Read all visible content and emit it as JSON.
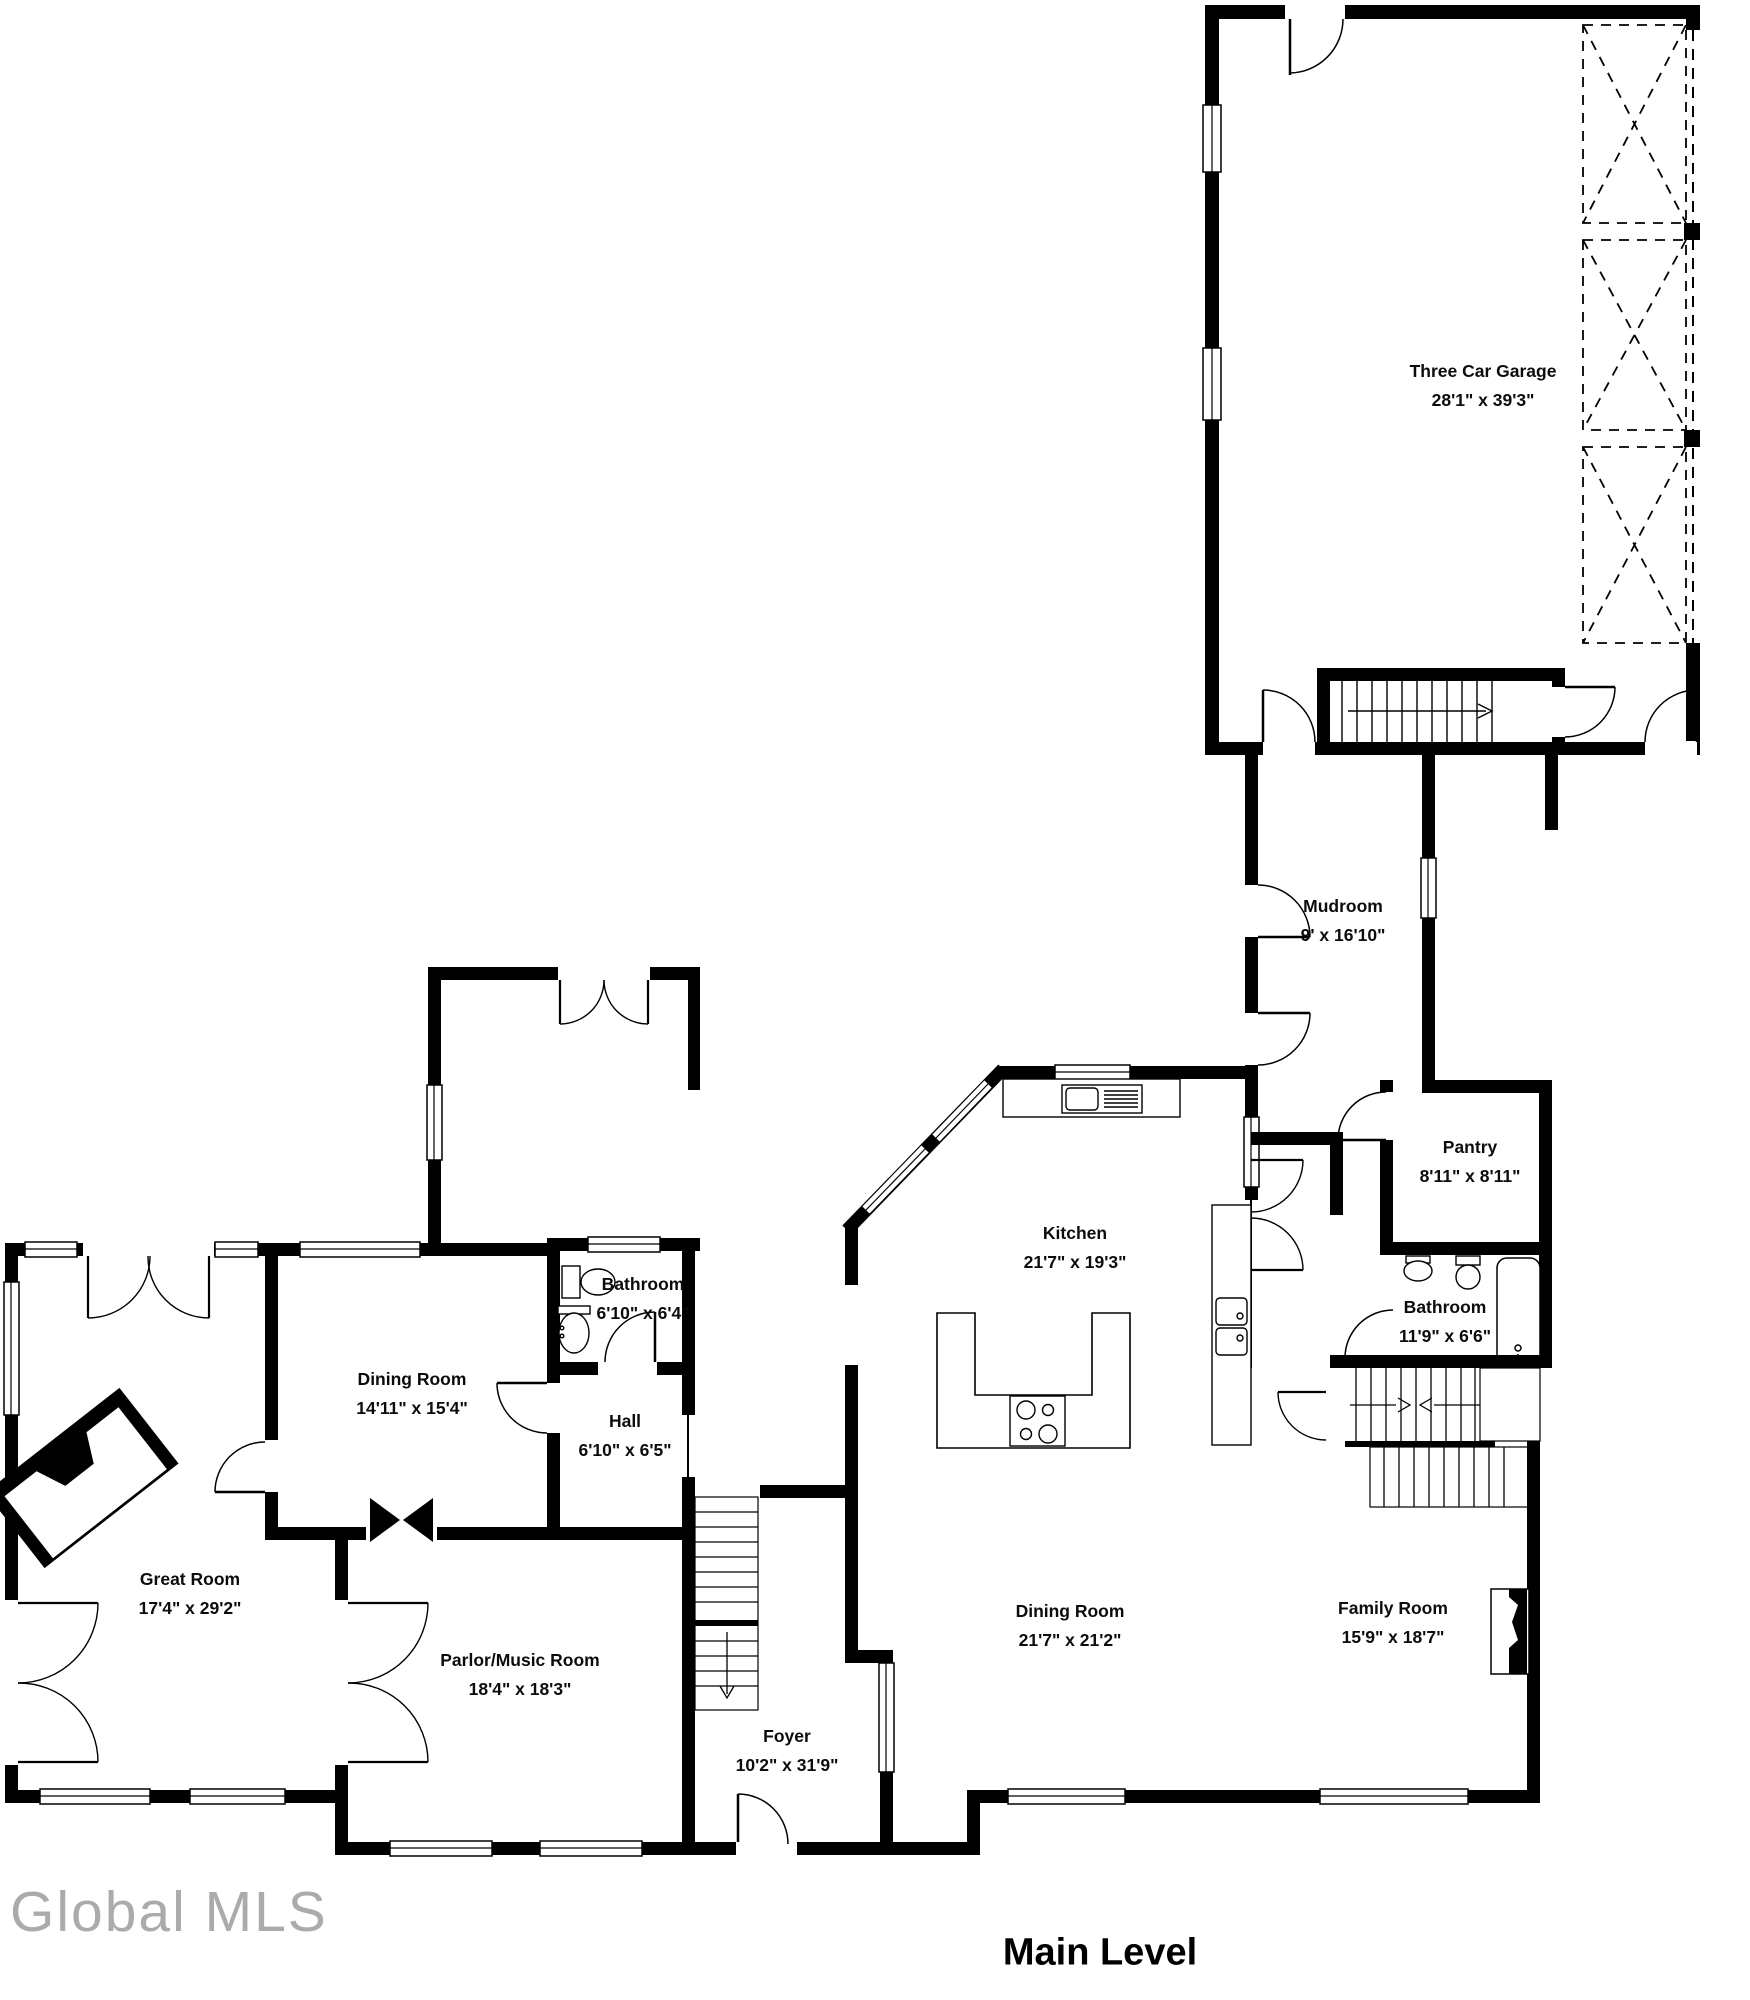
{
  "title": "Main Level",
  "watermark": "Global MLS",
  "colors": {
    "wall": "#000000",
    "background": "#ffffff",
    "watermark": "#ababab"
  },
  "rooms": [
    {
      "id": "three-car-garage",
      "name": "Three Car Garage",
      "dims": "28'1\" x 39'3\""
    },
    {
      "id": "mudroom",
      "name": "Mudroom",
      "dims": "9' x 16'10\""
    },
    {
      "id": "pantry",
      "name": "Pantry",
      "dims": "8'11\" x 8'11\""
    },
    {
      "id": "kitchen",
      "name": "Kitchen",
      "dims": "21'7\" x 19'3\""
    },
    {
      "id": "bathroom-main",
      "name": "Bathroom",
      "dims": "11'9\" x 6'6\""
    },
    {
      "id": "bathroom-small",
      "name": "Bathroom",
      "dims": "6'10\" x 6'4\""
    },
    {
      "id": "dining-room-left",
      "name": "Dining Room",
      "dims": "14'11\" x 15'4\""
    },
    {
      "id": "hall",
      "name": "Hall",
      "dims": "6'10\" x 6'5\""
    },
    {
      "id": "great-room",
      "name": "Great Room",
      "dims": "17'4\" x 29'2\""
    },
    {
      "id": "parlor-music-room",
      "name": "Parlor/Music Room",
      "dims": "18'4\" x 18'3\""
    },
    {
      "id": "dining-room-main",
      "name": "Dining Room",
      "dims": "21'7\" x 21'2\""
    },
    {
      "id": "family-room",
      "name": "Family Room",
      "dims": "15'9\" x 18'7\""
    },
    {
      "id": "foyer",
      "name": "Foyer",
      "dims": "10'2\" x 31'9\""
    }
  ]
}
